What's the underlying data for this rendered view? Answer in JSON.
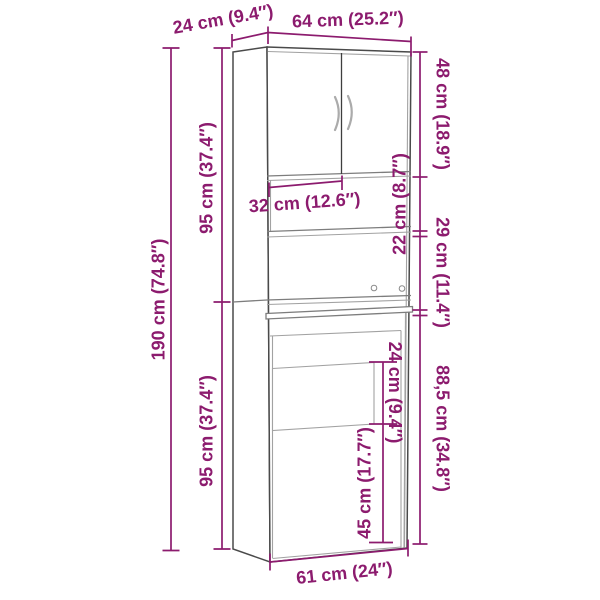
{
  "diagram": {
    "type": "furniture-dimension-diagram",
    "colors": {
      "accent": "#8c1b6e",
      "outline": "#4a4a4a",
      "inner_line": "#a2a2a2",
      "mid_line": "#7d7d7d"
    },
    "labels": {
      "depth_top": "24 cm (9.4″)",
      "width_total": "64 cm (25.2″)",
      "top_section": "48 cm (18.9″)",
      "shelf_space": "22 cm (8.7″)",
      "middle_section": "29 cm (11.4″)",
      "lower_section": "88,5 cm (34.8″)",
      "niche_upper": "24 cm (9.4″)",
      "niche_lower": "45 cm (17.7″)",
      "inner_width": "32 cm (12.6″)",
      "upper_height": "95 cm (37.4″)",
      "total_height": "190 cm (74.8″)",
      "lower_height": "95 cm (37.4″)",
      "base_width": "61 cm (24″)"
    }
  }
}
